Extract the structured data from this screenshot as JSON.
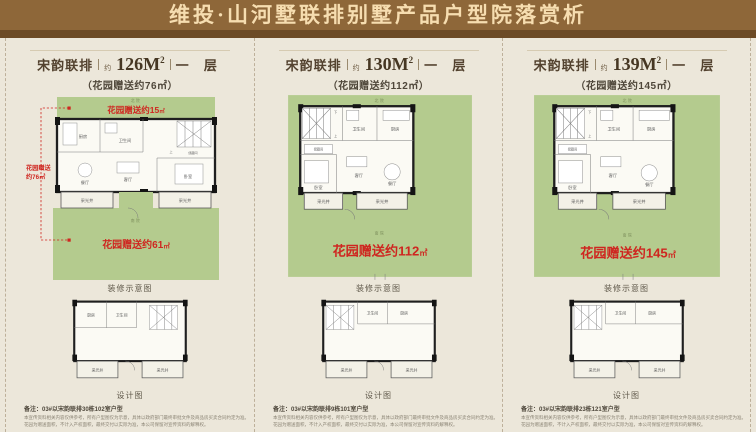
{
  "banner": {
    "title": "维投·山河墅联排别墅产品户型院落赏析"
  },
  "panels": [
    {
      "header": {
        "series": "宋韵联排",
        "approx": "约",
        "area": "126M",
        "sup": "2",
        "floor": "一 层"
      },
      "subtitle": "（花园赠送约76㎡）",
      "plan": {
        "yard_top": "北院",
        "yard_bottom": "南院",
        "garden_top_text": "花园赠送约15",
        "garden_top_unit": "㎡",
        "garden_side1": "花园赠送",
        "garden_side2": "约76㎡",
        "garden_bottom_text": "花园赠送约61",
        "garden_bottom_unit": "㎡",
        "rooms": {
          "kitchen": "厨房",
          "bath": "卫生间",
          "dining": "餐厅",
          "living": "客厅",
          "bedroom": "卧室",
          "closet": "储藏间",
          "well_left": "采光井",
          "well_right": "采光井",
          "up": "上"
        }
      },
      "caption_top": "装修示意图",
      "lower": {
        "kitchen": "厨房",
        "bath": "卫生间",
        "well_left": "采光井",
        "well_right": "采光井"
      },
      "caption_bottom": "设计图",
      "note": "备注：03#以宋韵联排30栋102室户型",
      "disclaimer1": "本宣传资料相关内容仅供参考，所有户型图仅为示意，具体以政府部门最终审批文件及商品房买卖合同约定为准。",
      "disclaimer2": "花园为赠送面积，不计入产权面积，最终交付以实际为准，本公司保留对宣传资料的解释权。"
    },
    {
      "header": {
        "series": "宋韵联排",
        "approx": "约",
        "area": "130M",
        "sup": "2",
        "floor": "一 层"
      },
      "subtitle": "（花园赠送约112㎡）",
      "plan": {
        "yard_top": "北院",
        "yard_bottom": "南院",
        "garden_main_text": "花园赠送约112",
        "garden_main_unit": "㎡",
        "rooms": {
          "kitchen": "厨房",
          "bath": "卫生间",
          "dining": "餐厅",
          "living": "客厅",
          "bedroom": "卧室",
          "closet": "储藏间",
          "well_left": "采光井",
          "well_right": "采光井",
          "up": "上",
          "down": "下"
        }
      },
      "caption_top": "装修示意图",
      "lower": {
        "kitchen": "厨房",
        "bath": "卫生间",
        "well_left": "采光井",
        "well_right": "采光井"
      },
      "caption_bottom": "设计图",
      "note": "备注：03#以宋韵联排9栋101室户型",
      "disclaimer1": "本宣传资料相关内容仅供参考，所有户型图仅为示意，具体以政府部门最终审批文件及商品房买卖合同约定为准。",
      "disclaimer2": "花园为赠送面积，不计入产权面积，最终交付以实际为准，本公司保留对宣传资料的解释权。"
    },
    {
      "header": {
        "series": "宋韵联排",
        "approx": "约",
        "area": "139M",
        "sup": "2",
        "floor": "一 层"
      },
      "subtitle": "（花园赠送约145㎡）",
      "plan": {
        "yard_top": "北院",
        "yard_bottom": "南院",
        "garden_main_text": "花园赠送约145",
        "garden_main_unit": "㎡",
        "rooms": {
          "kitchen": "厨房",
          "bath": "卫生间",
          "dining": "餐厅",
          "living": "客厅",
          "bedroom": "卧室",
          "closet": "储藏间",
          "well_left": "采光井",
          "well_right": "采光井",
          "up": "上",
          "down": "下"
        }
      },
      "caption_top": "装修示意图",
      "lower": {
        "kitchen": "厨房",
        "bath": "卫生间",
        "well_left": "采光井",
        "well_right": "采光井"
      },
      "caption_bottom": "设计图",
      "note": "备注：03#以宋韵联排23栋121室户型",
      "disclaimer1": "本宣传资料相关内容仅供参考，所有户型图仅为示意，具体以政府部门最终审批文件及商品房买卖合同约定为准。",
      "disclaimer2": "花园为赠送面积，不计入产权面积，最终交付以实际为准，本公司保留对宣传资料的解释权。"
    }
  ]
}
